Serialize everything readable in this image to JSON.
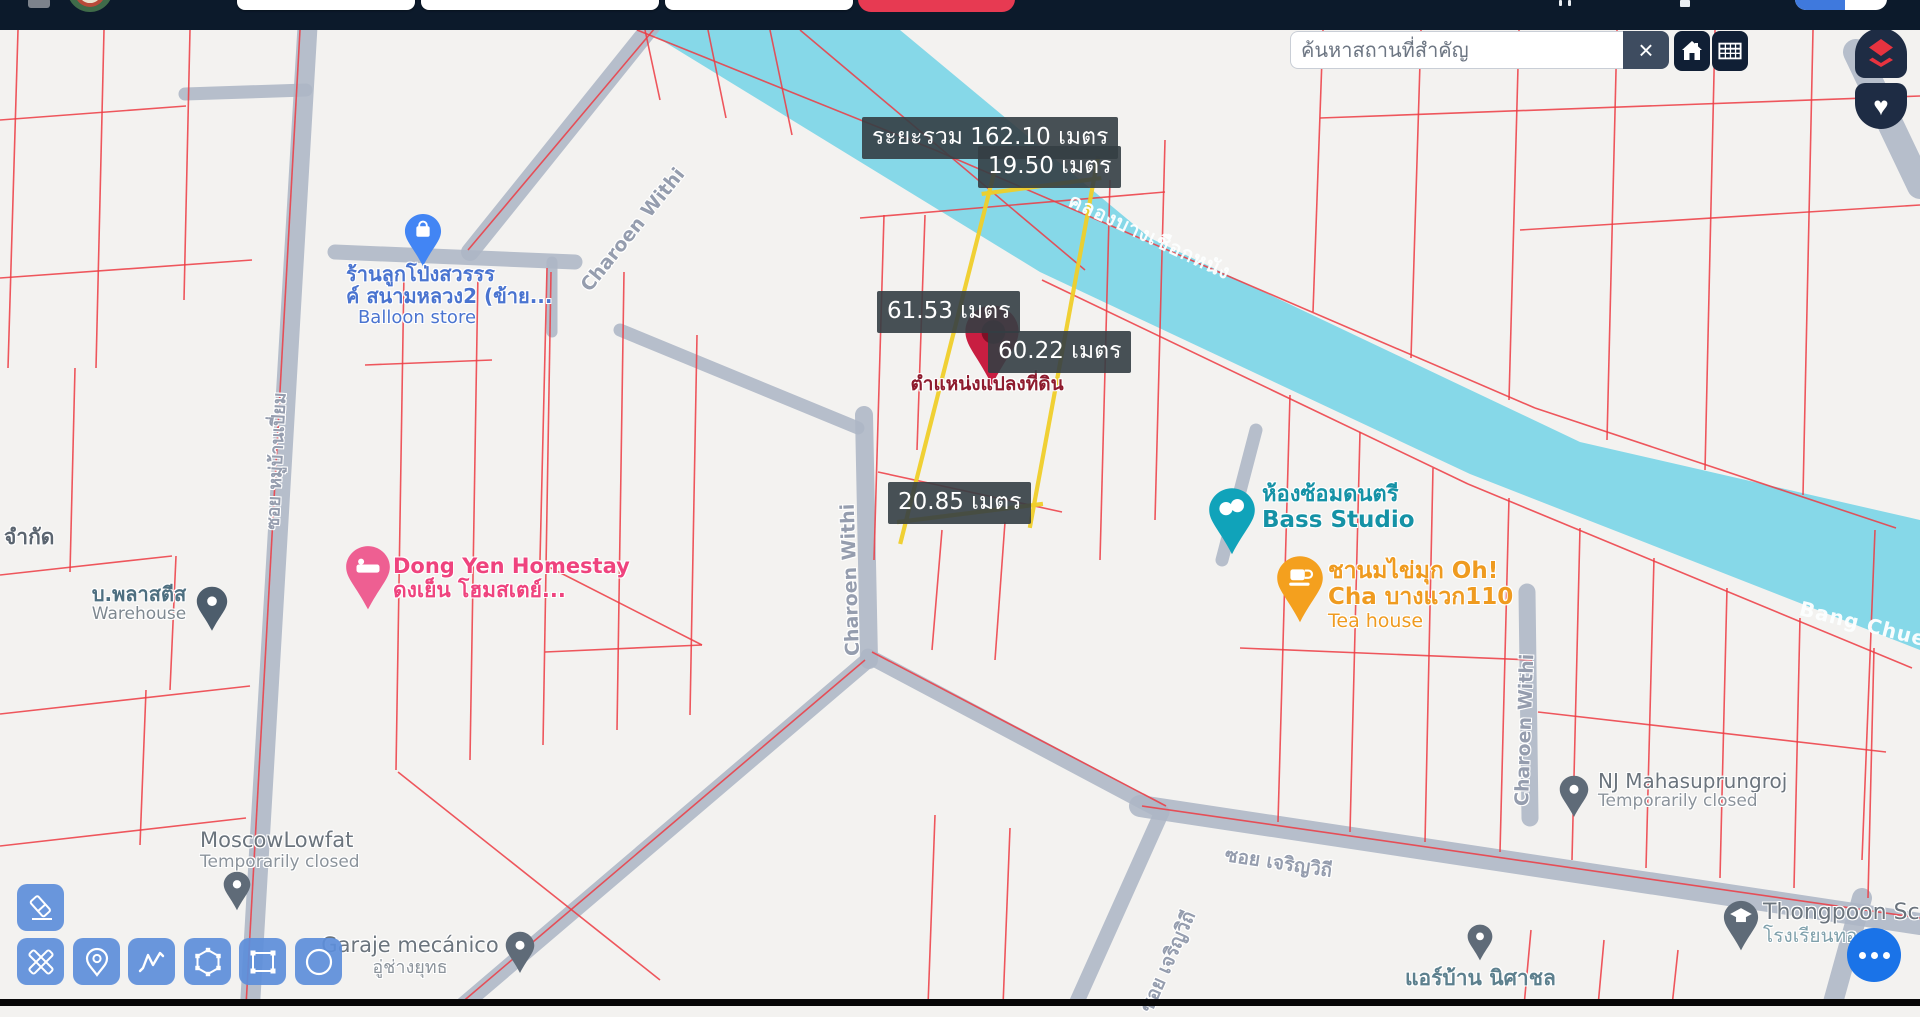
{
  "topbar": {
    "bg": "#0c1a2b",
    "signup_color": "#e73a52",
    "lang_toggle_left_color": "#3f79dd"
  },
  "search": {
    "placeholder": "ค้นหาสถานที่สำคัญ",
    "clear_label": "×"
  },
  "controls": {
    "home_icon": "home-icon",
    "grid_icon": "table-grid-icon",
    "layers_icon": "red-layers-icon",
    "favorite_icon": "heart-icon",
    "favorite_glyph": "♥",
    "fab_icon": "more-dots-icon"
  },
  "measure": {
    "total": "ระยะรวม 162.10 เมตร",
    "seg_top": "19.50 เมตร",
    "seg_left": "61.53 เมตร",
    "seg_mid": "60.22 เมตร",
    "seg_bottom": "20.85 เมตร",
    "parcel_caption": "ตำแหน่งแปลงที่ดิน"
  },
  "toolbar": {
    "tools": [
      "eraser",
      "measure-draw",
      "pin",
      "polyline",
      "polygon",
      "rectangle",
      "circle"
    ],
    "button_color": "#5d8eda"
  },
  "map": {
    "bg": "#f3f2f0",
    "road_color": "#aeb7c6",
    "cadastral_color": "#ee3b43",
    "canal": {
      "color": "#86d8e8",
      "points": "645,30 900,30 1150,238 1580,442 1920,520 1920,650 1470,474 1040,272",
      "labels": [
        {
          "text": "คลองบางเชือกหนัง",
          "x": 1070,
          "y": 183,
          "angle": 25,
          "size": 20
        },
        {
          "text": "Bang Chuea",
          "x": 1800,
          "y": 596,
          "angle": 14,
          "size": 20
        }
      ]
    },
    "roads": [
      [
        308,
        18,
        250,
        1006,
        20
      ],
      [
        658,
        18,
        470,
        252,
        18
      ],
      [
        335,
        252,
        575,
        262,
        15
      ],
      [
        552,
        262,
        552,
        332,
        11
      ],
      [
        620,
        330,
        858,
        428,
        13
      ],
      [
        864,
        415,
        869,
        660,
        18
      ],
      [
        868,
        660,
        462,
        1006,
        16
      ],
      [
        868,
        656,
        1162,
        812,
        15
      ],
      [
        1140,
        806,
        1920,
        924,
        22
      ],
      [
        1162,
        812,
        1075,
        1006,
        15
      ],
      [
        1527,
        592,
        1530,
        818,
        17
      ],
      [
        1256,
        430,
        1222,
        560,
        13
      ],
      [
        1856,
        52,
        1920,
        186,
        26
      ],
      [
        1862,
        898,
        1832,
        1006,
        20
      ],
      [
        185,
        94,
        306,
        90,
        13
      ]
    ],
    "cadastral_lines": [
      [
        18,
        30,
        8,
        368
      ],
      [
        104,
        30,
        96,
        368
      ],
      [
        190,
        30,
        184,
        300
      ],
      [
        0,
        120,
        186,
        106
      ],
      [
        0,
        278,
        252,
        260
      ],
      [
        75,
        368,
        70,
        572
      ],
      [
        0,
        575,
        172,
        556
      ],
      [
        176,
        556,
        170,
        690
      ],
      [
        0,
        714,
        250,
        686
      ],
      [
        0,
        846,
        246,
        818
      ],
      [
        146,
        690,
        140,
        845
      ],
      [
        300,
        30,
        246,
        1006
      ],
      [
        655,
        28,
        468,
        250
      ],
      [
        404,
        272,
        396,
        770
      ],
      [
        478,
        272,
        470,
        760
      ],
      [
        551,
        272,
        543,
        745
      ],
      [
        624,
        272,
        617,
        730
      ],
      [
        697,
        335,
        690,
        715
      ],
      [
        365,
        365,
        492,
        360
      ],
      [
        398,
        772,
        660,
        980
      ],
      [
        547,
        268,
        540,
        560
      ],
      [
        545,
        565,
        702,
        645
      ],
      [
        545,
        652,
        702,
        645
      ],
      [
        884,
        215,
        874,
        560
      ],
      [
        925,
        215,
        917,
        450
      ],
      [
        1110,
        180,
        1100,
        560
      ],
      [
        1165,
        140,
        1155,
        520
      ],
      [
        860,
        218,
        1165,
        192
      ],
      [
        878,
        472,
        1062,
        512
      ],
      [
        1005,
        522,
        995,
        660
      ],
      [
        942,
        530,
        932,
        650
      ],
      [
        645,
        30,
        660,
        100
      ],
      [
        708,
        30,
        726,
        118
      ],
      [
        770,
        30,
        792,
        135
      ],
      [
        637,
        30,
        935,
        150
      ],
      [
        935,
        150,
        1535,
        408
      ],
      [
        1535,
        408,
        1896,
        528
      ],
      [
        800,
        30,
        1085,
        270
      ],
      [
        1042,
        280,
        1468,
        484
      ],
      [
        1468,
        484,
        1912,
        668
      ],
      [
        1323,
        30,
        1313,
        312
      ],
      [
        1421,
        30,
        1411,
        358
      ],
      [
        1519,
        30,
        1509,
        400
      ],
      [
        1617,
        30,
        1607,
        440
      ],
      [
        1715,
        30,
        1705,
        470
      ],
      [
        1813,
        30,
        1803,
        495
      ],
      [
        1320,
        118,
        1920,
        96
      ],
      [
        1520,
        230,
        1920,
        205
      ],
      [
        1290,
        395,
        1278,
        822
      ],
      [
        1360,
        432,
        1350,
        832
      ],
      [
        1433,
        468,
        1425,
        842
      ],
      [
        1509,
        498,
        1500,
        852
      ],
      [
        1580,
        528,
        1572,
        860
      ],
      [
        1654,
        558,
        1646,
        868
      ],
      [
        1727,
        588,
        1720,
        878
      ],
      [
        1800,
        618,
        1794,
        888
      ],
      [
        1874,
        648,
        1868,
        898
      ],
      [
        1240,
        648,
        1532,
        660
      ],
      [
        1538,
        712,
        1886,
        752
      ],
      [
        872,
        652,
        1166,
        806
      ],
      [
        865,
        660,
        460,
        1004
      ],
      [
        1142,
        806,
        1920,
        918
      ],
      [
        935,
        815,
        928,
        1006
      ],
      [
        1010,
        828,
        1003,
        1006
      ],
      [
        1531,
        930,
        1524,
        1006
      ],
      [
        1604,
        940,
        1598,
        1006
      ],
      [
        1678,
        950,
        1672,
        1006
      ],
      [
        1875,
        530,
        1862,
        860
      ]
    ],
    "parcel": {
      "color": "#f0cf2a",
      "corners": [
        [
          989,
          193
        ],
        [
          1094,
          179
        ],
        [
          1034,
          505
        ],
        [
          906,
          521
        ]
      ]
    },
    "marker": {
      "color": "#c81e41",
      "inner": "#7d1026"
    },
    "street_labels": [
      {
        "text": "Charoen Withi",
        "x": 585,
        "y": 278,
        "angle": -51,
        "size": 19
      },
      {
        "text": "Charoen Withi",
        "x": 853,
        "y": 645,
        "angle": -92,
        "size": 19
      },
      {
        "text": "Charoen Withi",
        "x": 1522,
        "y": 795,
        "angle": -88,
        "size": 19
      },
      {
        "text": "ซอย หมู่บ้านเปี่ยม",
        "x": 272,
        "y": 515,
        "angle": -87,
        "size": 18
      },
      {
        "text": "ซอย เจริญวิถี",
        "x": 1225,
        "y": 840,
        "angle": 8.5,
        "size": 19
      },
      {
        "text": "ซอย เจริญวิถี",
        "x": 1146,
        "y": 996,
        "angle": -66,
        "size": 19
      }
    ],
    "pois": [
      {
        "id": "balloon-store",
        "pin": {
          "x": 423,
          "tip": 268,
          "size": 38,
          "color": "#4285f4",
          "icon": "shopping-bag"
        },
        "label": {
          "x": 346,
          "y": 263,
          "w": 142,
          "align": "center",
          "lines": [
            {
              "t": "ร้านลูกโป่งสวรรร",
              "fs": 20,
              "fw": "bold",
              "c": "#4a74d0"
            },
            {
              "t": "ค์ สนามหลวง2 (ข้าย...",
              "fs": 20,
              "fw": "bold",
              "c": "#4a74d0"
            },
            {
              "t": "Balloon store",
              "fs": 18,
              "fw": "normal",
              "c": "#4a74d0"
            }
          ]
        }
      },
      {
        "id": "dong-yen-homestay",
        "pin": {
          "x": 368,
          "tip": 612,
          "size": 46,
          "color": "#ee5f92",
          "icon": "bed"
        },
        "label": {
          "x": 393,
          "y": 555,
          "w": 220,
          "align": "left",
          "lines": [
            {
              "t": "Dong Yen Homestay",
              "fs": 21,
              "fw": "bold",
              "c": "#ef437e"
            },
            {
              "t": "ดงเย็น โฮมสเตย์...",
              "fs": 21,
              "fw": "bold",
              "c": "#ef437e"
            }
          ]
        }
      },
      {
        "id": "bass-studio",
        "pin": {
          "x": 1232,
          "tip": 557,
          "size": 48,
          "color": "#10a3ba",
          "icon": "masks"
        },
        "label": {
          "x": 1262,
          "y": 483,
          "w": 160,
          "align": "left",
          "lines": [
            {
              "t": "ห้องซ้อมดนตรี",
              "fs": 22,
              "fw": "bold",
              "c": "#1592a6"
            },
            {
              "t": "Bass Studio",
              "fs": 23,
              "fw": "bold",
              "c": "#1592a6"
            }
          ]
        }
      },
      {
        "id": "ohcha-tea-house",
        "pin": {
          "x": 1300,
          "tip": 625,
          "size": 48,
          "color": "#f4a01e",
          "icon": "coffee-cup"
        },
        "label": {
          "x": 1328,
          "y": 559,
          "w": 190,
          "align": "left",
          "lines": [
            {
              "t": "ชานมไข่มุก Oh!",
              "fs": 23,
              "fw": "bold",
              "c": "#ef9b20"
            },
            {
              "t": "Cha บางแวก110",
              "fs": 23,
              "fw": "bold",
              "c": "#ef9b20"
            },
            {
              "t": "Tea house",
              "fs": 19,
              "fw": "normal",
              "c": "#ef9b20"
            }
          ]
        }
      },
      {
        "id": "moscowlowfat",
        "pin": {
          "x": 237,
          "tip": 912,
          "size": 28,
          "color": "#5f6b78",
          "icon": "circle-dot"
        },
        "label": {
          "x": 200,
          "y": 829,
          "w": 170,
          "align": "left",
          "lines": [
            {
              "t": "MoscowLowfat",
              "fs": 21,
              "fw": "normal",
              "c": "#6b747d"
            },
            {
              "t": "Temporarily closed",
              "fs": 17,
              "fw": "normal",
              "c": "#8b939b"
            }
          ]
        }
      },
      {
        "id": "plastis-warehouse",
        "pin": {
          "x": 212,
          "tip": 632,
          "size": 32,
          "color": "#4d5d6c",
          "icon": "circle-dot"
        },
        "label": {
          "x": 82,
          "y": 583,
          "w": 114,
          "align": "center",
          "lines": [
            {
              "t": "บ.พลาสตีส",
              "fs": 20,
              "fw": "bold",
              "c": "#4e6f80"
            },
            {
              "t": "Warehouse",
              "fs": 17,
              "fw": "normal",
              "c": "#7e8890"
            }
          ]
        }
      },
      {
        "id": "nj-mahasuprungroj",
        "pin": {
          "x": 1574,
          "tip": 818,
          "size": 30,
          "color": "#5f6b78",
          "icon": "circle-dot"
        },
        "label": {
          "x": 1598,
          "y": 770,
          "w": 200,
          "align": "left",
          "lines": [
            {
              "t": "NJ Mahasuprungroj",
              "fs": 20,
              "fw": "normal",
              "c": "#6b747d"
            },
            {
              "t": "Temporarily closed",
              "fs": 17,
              "fw": "normal",
              "c": "#8b939b"
            }
          ]
        }
      },
      {
        "id": "thongpoon-school",
        "pin": {
          "x": 1741,
          "tip": 952,
          "size": 36,
          "color": "#5f6b78",
          "icon": "graduation-cap"
        },
        "label": {
          "x": 1763,
          "y": 901,
          "w": 160,
          "align": "left",
          "lines": [
            {
              "t": "Thongpoon Sch",
              "fs": 22,
              "fw": "normal",
              "c": "#6b747d"
            },
            {
              "t": "โรงเรียนทอ",
              "fs": 19,
              "fw": "normal",
              "c": "#7fa0ab"
            }
          ]
        }
      },
      {
        "id": "air-baan-nisachon",
        "pin": {
          "x": 1480,
          "tip": 962,
          "size": 26,
          "color": "#5f6b78",
          "icon": "circle-dot"
        },
        "label": {
          "x": 1405,
          "y": 967,
          "w": 175,
          "align": "left",
          "lines": [
            {
              "t": "แอร์บ้าน นิศาชล",
              "fs": 21,
              "fw": "bold",
              "c": "#5d808e"
            }
          ]
        }
      },
      {
        "id": "garaje-mecanico",
        "pin": {
          "x": 520,
          "tip": 974,
          "size": 30,
          "color": "#5f6b78",
          "icon": "circle-dot"
        },
        "label": {
          "x": 318,
          "y": 934,
          "w": 184,
          "align": "center",
          "lines": [
            {
              "t": "Garaje mecánico",
              "fs": 21,
              "fw": "normal",
              "c": "#6b747d"
            },
            {
              "t": "อู่ช่างยุทธ",
              "fs": 18,
              "fw": "normal",
              "c": "#8b939b"
            }
          ]
        }
      },
      {
        "id": "company-label-cut",
        "pin": null,
        "label": {
          "x": 4,
          "y": 526,
          "w": 80,
          "align": "left",
          "lines": [
            {
              "t": "จำกัด",
              "fs": 21,
              "fw": "bold",
              "c": "#5b6570"
            }
          ]
        }
      }
    ]
  },
  "fab": {
    "color": "#1a73e8"
  }
}
